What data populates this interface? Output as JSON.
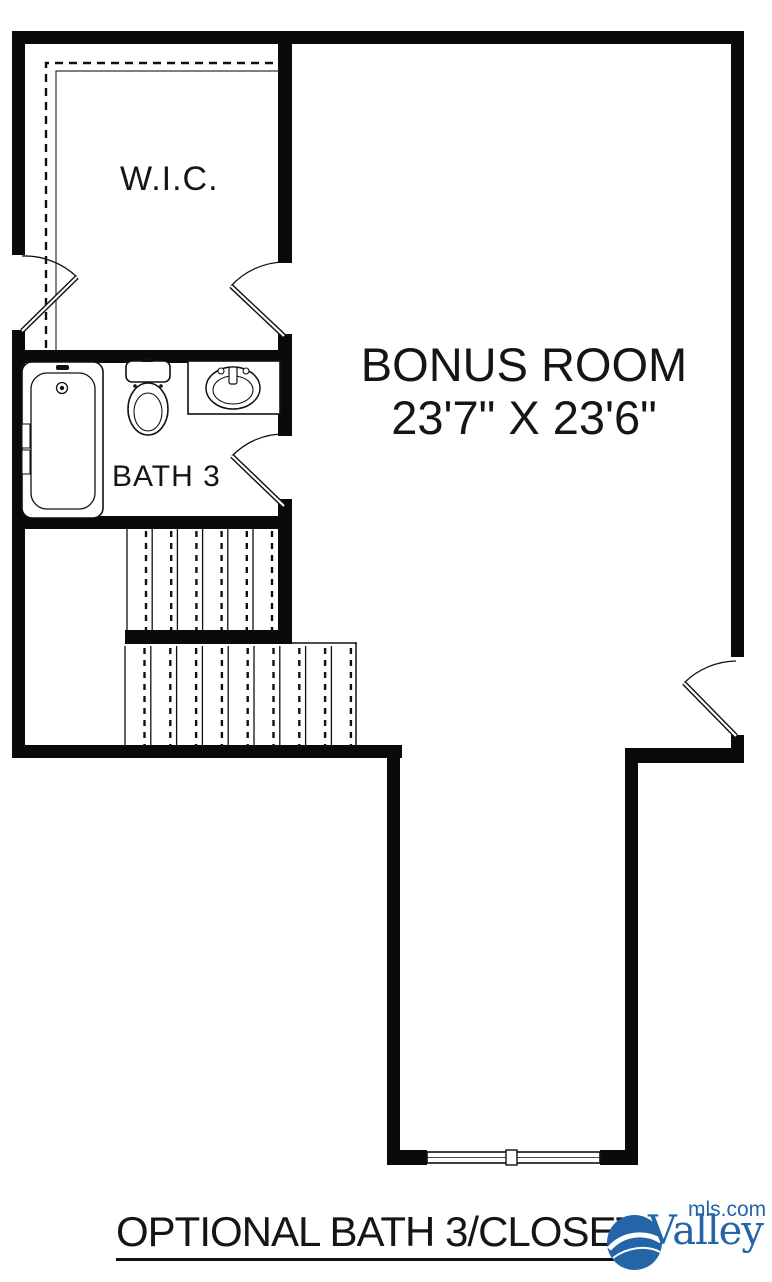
{
  "plan": {
    "rooms": {
      "wic": {
        "label": "W.I.C."
      },
      "bath": {
        "label": "BATH 3"
      },
      "bonus": {
        "label": "BONUS ROOM",
        "dimensions": "23'7\" X 23'6\""
      }
    },
    "caption": "OPTIONAL BATH 3/CLOSET",
    "fixture_icons": [
      "bathtub-icon",
      "toilet-icon",
      "sink-icon",
      "stairs-icon",
      "window-icon",
      "door-swing-icon"
    ]
  },
  "branding": {
    "logo_text": "Valley",
    "logo_suffix": "mls.com",
    "logo_color": "#2465a8"
  },
  "colors": {
    "wall": "#0a0a0a",
    "background": "#ffffff",
    "logo_blue": "#2465a8"
  }
}
